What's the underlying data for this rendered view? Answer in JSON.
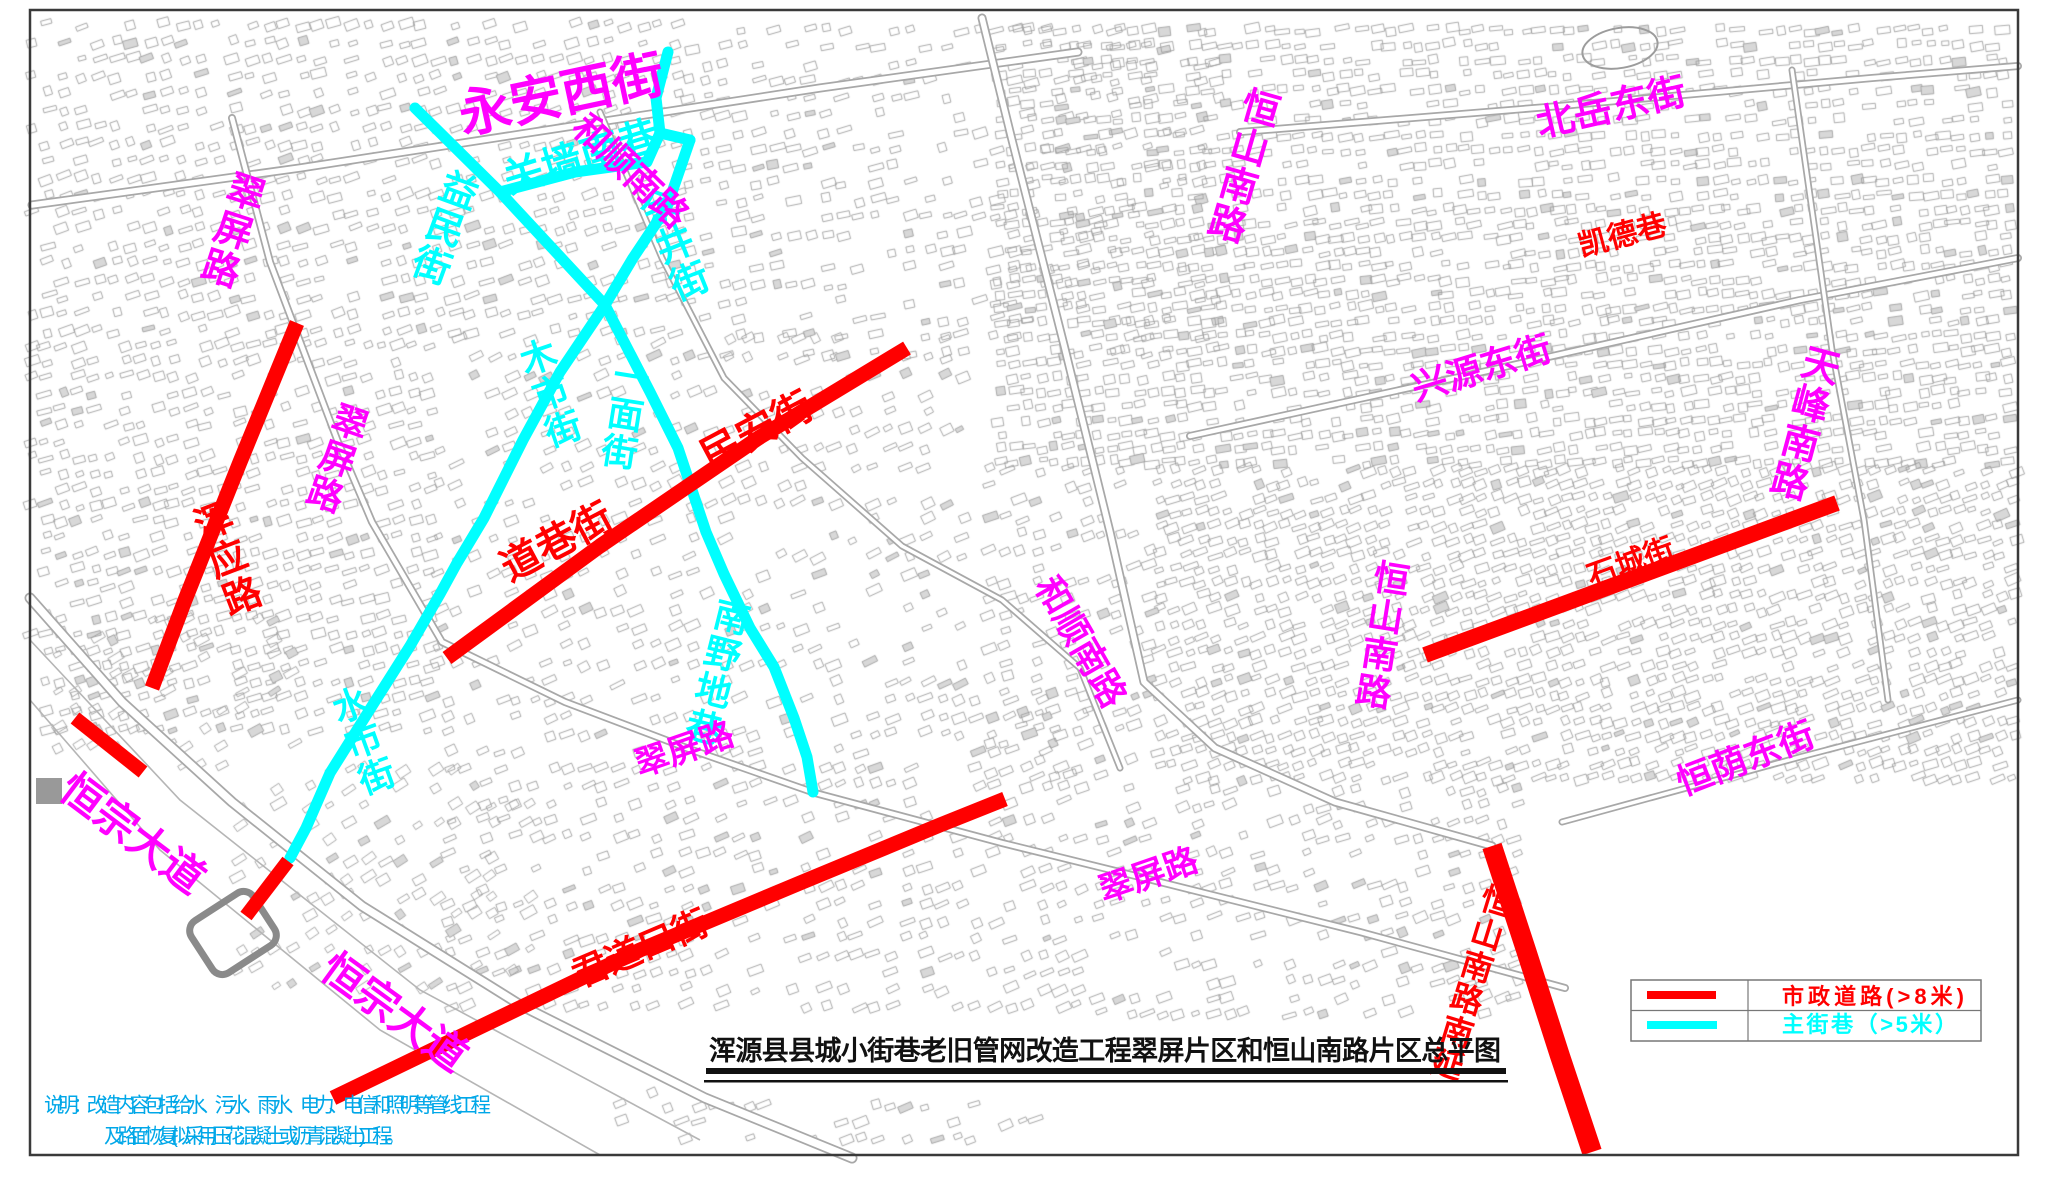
{
  "title": {
    "text": "浑源县县城小街巷老旧管网改造工程翠屏片区和恒山南路片区总平图"
  },
  "notes": {
    "line1": "说明：改造内容包括给水、污水、雨水、电力、电信和照明等管线工程",
    "line2": "及路面恢复(拟采用压花混凝土或沥青混凝土)工程。",
    "color": "#00a7e8"
  },
  "legend": {
    "items": [
      {
        "type": "municipal-road",
        "label": "市政道路(>8米)",
        "color": "#ff0000"
      },
      {
        "type": "main-alley",
        "label": "主街巷（>5米）",
        "color": "#00ffff"
      }
    ]
  },
  "colors": {
    "municipal_road": "#ff0000",
    "main_alley": "#00ffff",
    "street_label_magenta": "#ff00ff",
    "map_line_gray": "#a8a8a8",
    "frame": "#3a3a3a"
  },
  "map": {
    "labels": [
      {
        "text": "永安西街",
        "x": 565,
        "y": 112,
        "size": 52,
        "rot": -12,
        "mode": "h",
        "color": "#ff00ff"
      },
      {
        "text": "翠屏路",
        "x": 248,
        "y": 172,
        "size": 38,
        "rot": 18,
        "mode": "v",
        "color": "#ff00ff"
      },
      {
        "text": "关墙南巷",
        "x": 585,
        "y": 170,
        "size": 40,
        "rot": -17,
        "mode": "h",
        "color": "#00ffff"
      },
      {
        "text": "益民街",
        "x": 462,
        "y": 170,
        "size": 38,
        "rot": 20,
        "mode": "v",
        "color": "#00ffff"
      },
      {
        "text": "余井街",
        "x": 648,
        "y": 190,
        "size": 38,
        "rot": -22,
        "mode": "v",
        "color": "#00ffff"
      },
      {
        "text": "和顺南路",
        "x": 622,
        "y": 180,
        "size": 36,
        "rot": 44,
        "mode": "h",
        "color": "#ff00ff"
      },
      {
        "text": "恒山南路",
        "x": 1262,
        "y": 88,
        "size": 38,
        "rot": 16,
        "mode": "v",
        "color": "#ff00ff"
      },
      {
        "text": "北岳东街",
        "x": 1614,
        "y": 120,
        "size": 38,
        "rot": -13,
        "mode": "h",
        "color": "#ff00ff"
      },
      {
        "text": "凯德巷",
        "x": 1625,
        "y": 245,
        "size": 30,
        "rot": -15,
        "mode": "h",
        "color": "#ff0000"
      },
      {
        "text": "兴源东街",
        "x": 1485,
        "y": 380,
        "size": 36,
        "rot": -17,
        "mode": "h",
        "color": "#ff00ff"
      },
      {
        "text": "天峰南路",
        "x": 1822,
        "y": 345,
        "size": 38,
        "rot": 15,
        "mode": "v",
        "color": "#ff00ff"
      },
      {
        "text": "石城街",
        "x": 1634,
        "y": 572,
        "size": 30,
        "rot": -20,
        "mode": "h",
        "color": "#ff0000"
      },
      {
        "text": "恒山南路",
        "x": 1392,
        "y": 560,
        "size": 36,
        "rot": 9,
        "mode": "v",
        "color": "#ff00ff"
      },
      {
        "text": "恒荫东街",
        "x": 1750,
        "y": 770,
        "size": 36,
        "rot": -21,
        "mode": "h",
        "color": "#ff00ff"
      },
      {
        "text": "民安街",
        "x": 763,
        "y": 443,
        "size": 40,
        "rot": -28,
        "mode": "h",
        "color": "#ff0000"
      },
      {
        "text": "道巷街",
        "x": 563,
        "y": 554,
        "size": 40,
        "rot": -28,
        "mode": "h",
        "color": "#ff0000"
      },
      {
        "text": "一面街",
        "x": 632,
        "y": 358,
        "size": 36,
        "rot": 9,
        "mode": "v",
        "color": "#00ffff"
      },
      {
        "text": "木市街",
        "x": 530,
        "y": 340,
        "size": 36,
        "rot": -19,
        "mode": "v",
        "color": "#00ffff"
      },
      {
        "text": "南野地巷",
        "x": 734,
        "y": 598,
        "size": 36,
        "rot": 14,
        "mode": "v",
        "color": "#00ffff"
      },
      {
        "text": "水市街",
        "x": 342,
        "y": 688,
        "size": 36,
        "rot": -20,
        "mode": "v",
        "color": "#00ffff"
      },
      {
        "text": "翠屏路",
        "x": 354,
        "y": 404,
        "size": 36,
        "rot": 19,
        "mode": "v",
        "color": "#ff00ff"
      },
      {
        "text": "浑应路",
        "x": 202,
        "y": 504,
        "size": 38,
        "rot": -21,
        "mode": "v",
        "color": "#ff0000"
      },
      {
        "text": "翠屏路",
        "x": 688,
        "y": 760,
        "size": 34,
        "rot": -19,
        "mode": "h",
        "color": "#ff00ff"
      },
      {
        "text": "翠屏路",
        "x": 1152,
        "y": 886,
        "size": 34,
        "rot": -19,
        "mode": "h",
        "color": "#ff00ff"
      },
      {
        "text": "和顺南路",
        "x": 1070,
        "y": 648,
        "size": 36,
        "rot": 60,
        "mode": "h",
        "color": "#ff00ff"
      },
      {
        "text": "恒宗大道",
        "x": 124,
        "y": 845,
        "size": 42,
        "rot": 37,
        "mode": "h",
        "color": "#ff00ff"
      },
      {
        "text": "恒宗大道",
        "x": 386,
        "y": 1024,
        "size": 42,
        "rot": 36,
        "mode": "h",
        "color": "#ff00ff"
      },
      {
        "text": "君道口街",
        "x": 645,
        "y": 960,
        "size": 36,
        "rot": -23,
        "mode": "h",
        "color": "#ff0000"
      },
      {
        "text": "恒山南路南延",
        "x": 1500,
        "y": 885,
        "size": 32,
        "rot": 17,
        "mode": "v",
        "color": "#ff0000"
      }
    ],
    "cyan_roads": [
      {
        "w": 11,
        "pts": [
          [
            415,
            108
          ],
          [
            500,
            192
          ],
          [
            605,
            305
          ],
          [
            650,
            392
          ],
          [
            678,
            448
          ],
          [
            706,
            532
          ],
          [
            724,
            574
          ],
          [
            750,
            628
          ],
          [
            774,
            667
          ],
          [
            794,
            718
          ],
          [
            807,
            757
          ],
          [
            813,
            792
          ]
        ]
      },
      {
        "w": 11,
        "pts": [
          [
            500,
            192
          ],
          [
            575,
            172
          ],
          [
            647,
            162
          ],
          [
            660,
            133
          ],
          [
            690,
            140
          ]
        ]
      },
      {
        "w": 11,
        "pts": [
          [
            668,
            52
          ],
          [
            656,
            98
          ],
          [
            660,
            133
          ]
        ]
      },
      {
        "w": 11,
        "pts": [
          [
            690,
            140
          ],
          [
            667,
            207
          ],
          [
            633,
            258
          ],
          [
            605,
            305
          ],
          [
            560,
            372
          ],
          [
            523,
            440
          ],
          [
            484,
            518
          ],
          [
            457,
            563
          ],
          [
            440,
            594
          ],
          [
            410,
            646
          ],
          [
            372,
            706
          ],
          [
            330,
            773
          ],
          [
            306,
            828
          ],
          [
            290,
            858
          ]
        ]
      }
    ],
    "red_roads": [
      {
        "w": 15,
        "pts": [
          [
            297,
            323
          ],
          [
            240,
            462
          ],
          [
            185,
            600
          ],
          [
            152,
            688
          ]
        ]
      },
      {
        "w": 14,
        "pts": [
          [
            75,
            718
          ],
          [
            143,
            772
          ]
        ]
      },
      {
        "w": 14,
        "pts": [
          [
            288,
            861
          ],
          [
            246,
            916
          ]
        ]
      },
      {
        "w": 15,
        "pts": [
          [
            447,
            658
          ],
          [
            600,
            546
          ],
          [
            760,
            437
          ],
          [
            907,
            348
          ]
        ]
      },
      {
        "w": 15,
        "pts": [
          [
            333,
            1098
          ],
          [
            480,
            1027
          ],
          [
            640,
            950
          ],
          [
            800,
            883
          ],
          [
            940,
            825
          ],
          [
            1005,
            799
          ]
        ]
      },
      {
        "w": 16,
        "pts": [
          [
            1425,
            655
          ],
          [
            1837,
            503
          ]
        ]
      },
      {
        "w": 20,
        "pts": [
          [
            1492,
            846
          ],
          [
            1526,
            950
          ],
          [
            1560,
            1056
          ],
          [
            1592,
            1152
          ]
        ]
      }
    ],
    "gray_roads": [
      {
        "w": 9,
        "pts": [
          [
            32,
            205
          ],
          [
            300,
            168
          ],
          [
            560,
            128
          ],
          [
            820,
            88
          ],
          [
            1078,
            52
          ]
        ]
      },
      {
        "w": 9,
        "pts": [
          [
            982,
            18
          ],
          [
            1012,
            140
          ],
          [
            1064,
            345
          ],
          [
            1110,
            532
          ],
          [
            1144,
            682
          ],
          [
            1215,
            748
          ],
          [
            1335,
            802
          ],
          [
            1492,
            846
          ]
        ]
      },
      {
        "w": 8,
        "pts": [
          [
            232,
            118
          ],
          [
            270,
            262
          ],
          [
            338,
            442
          ],
          [
            372,
            522
          ],
          [
            442,
            642
          ],
          [
            565,
            702
          ],
          [
            692,
            750
          ],
          [
            815,
            793
          ],
          [
            1002,
            843
          ],
          [
            1152,
            880
          ],
          [
            1360,
            932
          ],
          [
            1565,
            988
          ]
        ]
      },
      {
        "w": 11,
        "pts": [
          [
            30,
            598
          ],
          [
            122,
            702
          ],
          [
            232,
            802
          ],
          [
            362,
            906
          ],
          [
            522,
            1006
          ],
          [
            705,
            1098
          ],
          [
            852,
            1158
          ]
        ]
      },
      {
        "w": 7,
        "pts": [
          [
            600,
            112
          ],
          [
            662,
            258
          ],
          [
            724,
            378
          ],
          [
            802,
            458
          ],
          [
            902,
            546
          ],
          [
            1002,
            600
          ],
          [
            1080,
            668
          ],
          [
            1120,
            768
          ]
        ]
      },
      {
        "w": 8,
        "pts": [
          [
            1240,
            132
          ],
          [
            1560,
            106
          ],
          [
            1872,
            78
          ],
          [
            2018,
            66
          ]
        ]
      },
      {
        "w": 8,
        "pts": [
          [
            1190,
            436
          ],
          [
            1482,
            372
          ],
          [
            1800,
            300
          ],
          [
            2018,
            258
          ]
        ]
      },
      {
        "w": 7,
        "pts": [
          [
            1792,
            70
          ],
          [
            1832,
            350
          ],
          [
            1864,
            520
          ],
          [
            1888,
            700
          ]
        ]
      },
      {
        "w": 7,
        "pts": [
          [
            1562,
            822
          ],
          [
            1800,
            757
          ],
          [
            2018,
            700
          ]
        ]
      }
    ],
    "river_lines": [
      {
        "pts": [
          [
            30,
            640
          ],
          [
            180,
            800
          ],
          [
            420,
            990
          ],
          [
            700,
            1140
          ]
        ]
      },
      {
        "pts": [
          [
            30,
            700
          ],
          [
            160,
            850
          ],
          [
            380,
            1030
          ],
          [
            600,
            1155
          ]
        ]
      }
    ]
  }
}
